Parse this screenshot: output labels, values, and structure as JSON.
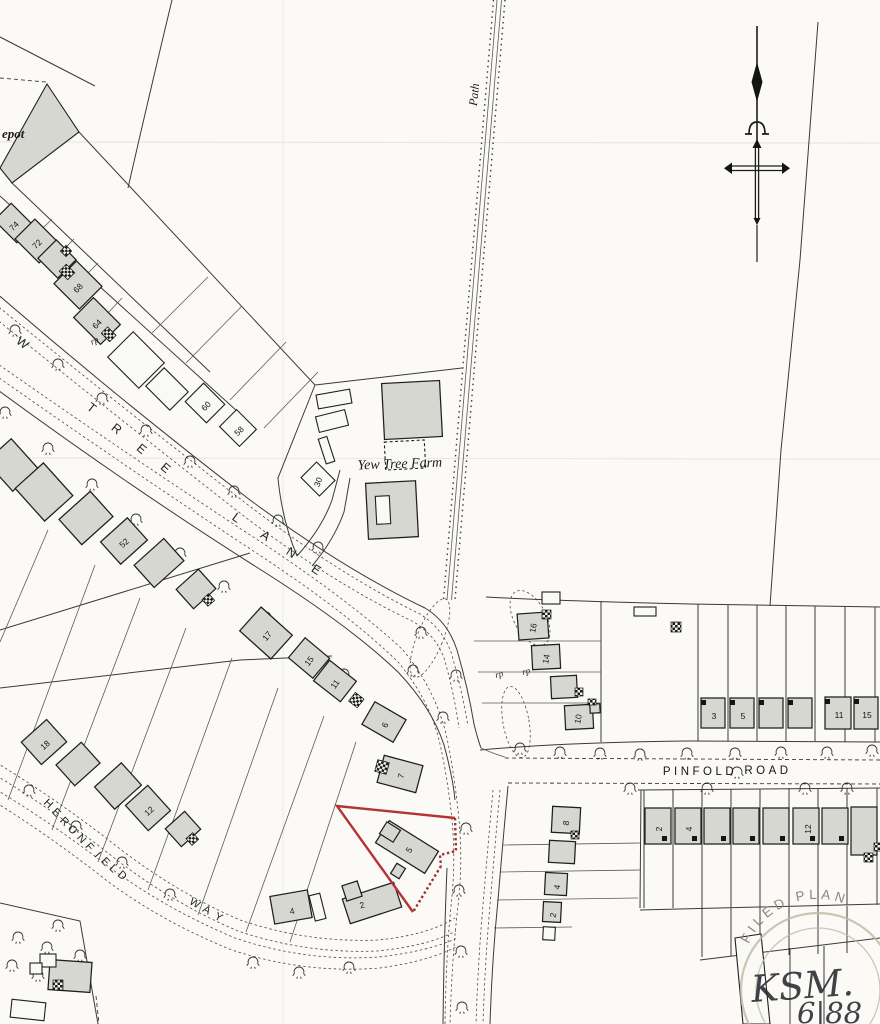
{
  "colors": {
    "paper": "#fbfaf6",
    "line": "#3a3a3a",
    "house_fill": "#d7d7d2",
    "plot_red": "#b23434",
    "stamp": "#c3b6a5",
    "ink": "#2d2d36"
  },
  "labels": {
    "depot": "epot",
    "path": "Path",
    "farm": "Yew Tree Farm",
    "rp_a": "rp",
    "rp_b": "rp",
    "rp_c": "rp",
    "stamp_arc": "FILED PLAN",
    "hand_initials": "KSM.",
    "hand_date": "6|88"
  },
  "streets": {
    "yew_tree_lane": {
      "letters": [
        "W",
        "T",
        "R",
        "E",
        "E",
        "L",
        "A",
        "N",
        "E"
      ]
    },
    "heronfield_way": {
      "letters": [
        "H",
        "E",
        "R",
        "O",
        "N",
        "F",
        "I",
        "E",
        "L",
        "D",
        "W",
        "A",
        "Y"
      ]
    },
    "pinfold_road": {
      "word1": "PINFOLD",
      "word2": "ROAD"
    }
  },
  "houses": [
    {
      "n": "74"
    },
    {
      "n": "72"
    },
    {
      "n": "68"
    },
    {
      "n": "64"
    },
    {
      "n": "60"
    },
    {
      "n": "58"
    },
    {
      "n": "30"
    },
    {
      "n": "52"
    },
    {
      "n": "17"
    },
    {
      "n": "15"
    },
    {
      "n": "11"
    },
    {
      "n": "6"
    },
    {
      "n": "7"
    },
    {
      "n": "5"
    },
    {
      "n": "2"
    },
    {
      "n": "4"
    },
    {
      "n": "12"
    },
    {
      "n": "18"
    },
    {
      "n": "16"
    },
    {
      "n": "14"
    },
    {
      "n": "10"
    },
    {
      "n": "3"
    },
    {
      "n": "5"
    },
    {
      "n": "11"
    },
    {
      "n": "15"
    },
    {
      "n": "2"
    },
    {
      "n": "4"
    },
    {
      "n": "12"
    },
    {
      "n": "8"
    },
    {
      "n": "4"
    },
    {
      "n": "2"
    }
  ]
}
